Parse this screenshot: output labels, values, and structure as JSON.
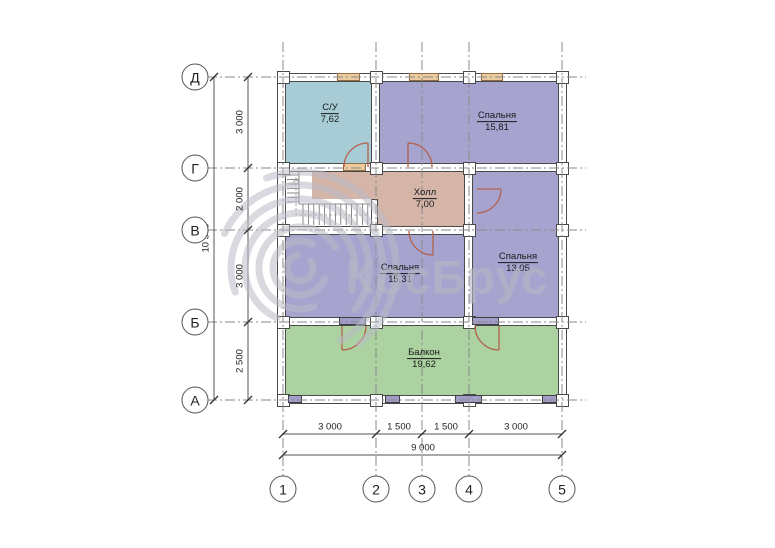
{
  "watermark": {
    "text": "КосБрус"
  },
  "grid": {
    "rows": [
      "Д",
      "Г",
      "В",
      "Б",
      "А"
    ],
    "cols": [
      "1",
      "2",
      "3",
      "4",
      "5"
    ]
  },
  "dimensions": {
    "vertical": {
      "segments": [
        "3 000",
        "2 000",
        "3 000",
        "2 500"
      ],
      "total": "10 500"
    },
    "horizontal": {
      "segments": [
        "3 000",
        "1 500",
        "1 500",
        "3 000"
      ],
      "total": "9 000"
    }
  },
  "rooms": [
    {
      "name": "С/У",
      "area": "7,62"
    },
    {
      "name": "Спальня",
      "area": "15,81"
    },
    {
      "name": "Холл",
      "area": "7,00"
    },
    {
      "name": "Спальня",
      "area": "15,31"
    },
    {
      "name": "Спальня",
      "area": "13,05"
    },
    {
      "name": "Балкон",
      "area": "19,62"
    }
  ],
  "colors": {
    "bathroom": "#a7ccd6",
    "bedroom": "#a6a4ce",
    "hall": "#d4b5a8",
    "balcony": "#abd2a0",
    "door_arc": "#b4604a",
    "window_exterior": "#eccb9e",
    "window_interior": "#a09dc9",
    "wall_line": "#4a4a4a",
    "grid_line": "#8a8a8a",
    "watermark": "#b7b7c5"
  }
}
